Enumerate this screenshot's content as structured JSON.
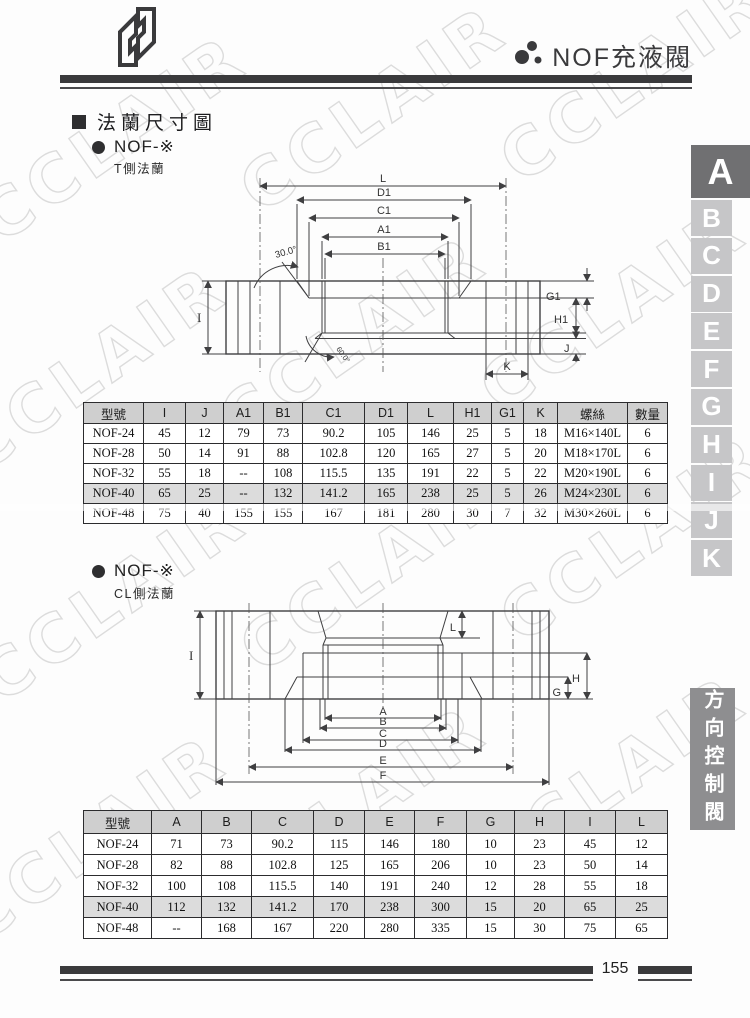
{
  "header": {
    "title": "NOF充液閥"
  },
  "section": {
    "title": "法蘭尺寸圖"
  },
  "groups": [
    {
      "label": "NOF-※",
      "sublabel": "T側法蘭"
    },
    {
      "label": "NOF-※",
      "sublabel": "CL側法蘭"
    }
  ],
  "drawing1": {
    "top_dims": [
      "L",
      "D1",
      "C1",
      "A1",
      "B1"
    ],
    "left_dim": "I",
    "right_dims": [
      "G1",
      "H1",
      "J"
    ],
    "bottom_dim": "K",
    "angle_top": "30.0°",
    "angle_bottom": "60.0°"
  },
  "drawing2": {
    "top_dim": "L",
    "left_dim": "I",
    "right_dims": [
      "H",
      "G"
    ],
    "bottom_dims": [
      "A",
      "B",
      "C",
      "D",
      "E",
      "F"
    ]
  },
  "table1": {
    "headers": [
      "型號",
      "I",
      "J",
      "A1",
      "B1",
      "C1",
      "D1",
      "L",
      "H1",
      "G1",
      "K",
      "螺絲",
      "數量"
    ],
    "rows": [
      [
        "NOF-24",
        "45",
        "12",
        "79",
        "73",
        "90.2",
        "105",
        "146",
        "25",
        "5",
        "18",
        "M16×140L",
        "6"
      ],
      [
        "NOF-28",
        "50",
        "14",
        "91",
        "88",
        "102.8",
        "120",
        "165",
        "27",
        "5",
        "20",
        "M18×170L",
        "6"
      ],
      [
        "NOF-32",
        "55",
        "18",
        "--",
        "108",
        "115.5",
        "135",
        "191",
        "22",
        "5",
        "22",
        "M20×190L",
        "6"
      ],
      [
        "NOF-40",
        "65",
        "25",
        "--",
        "132",
        "141.2",
        "165",
        "238",
        "25",
        "5",
        "26",
        "M24×230L",
        "6"
      ],
      [
        "NOF-48",
        "75",
        "40",
        "155",
        "155",
        "167",
        "181",
        "280",
        "30",
        "7",
        "32",
        "M30×260L",
        "6"
      ]
    ],
    "highlight_row_index": 3
  },
  "table2": {
    "headers": [
      "型號",
      "A",
      "B",
      "C",
      "D",
      "E",
      "F",
      "G",
      "H",
      "I",
      "L"
    ],
    "rows": [
      [
        "NOF-24",
        "71",
        "73",
        "90.2",
        "115",
        "146",
        "180",
        "10",
        "23",
        "45",
        "12"
      ],
      [
        "NOF-28",
        "82",
        "88",
        "102.8",
        "125",
        "165",
        "206",
        "10",
        "23",
        "50",
        "14"
      ],
      [
        "NOF-32",
        "100",
        "108",
        "115.5",
        "140",
        "191",
        "240",
        "12",
        "28",
        "55",
        "18"
      ],
      [
        "NOF-40",
        "112",
        "132",
        "141.2",
        "170",
        "238",
        "300",
        "15",
        "20",
        "65",
        "25"
      ],
      [
        "NOF-48",
        "--",
        "168",
        "167",
        "220",
        "280",
        "335",
        "15",
        "30",
        "75",
        "65"
      ]
    ],
    "highlight_row_index": 3
  },
  "sidebar": {
    "tabs": [
      "A",
      "B",
      "C",
      "D",
      "E",
      "F",
      "G",
      "H",
      "I",
      "J",
      "K"
    ],
    "active_tab": "A",
    "category_label": "方向控制閥"
  },
  "footer": {
    "page_number": "155"
  },
  "watermark": {
    "text": "CCLAIR"
  },
  "colors": {
    "bar": "#3a3a3c",
    "table_header_bg": "#cfcfcf",
    "highlight_row_bg": "#dcdcdc",
    "tab_active_bg": "#707072",
    "tab_bg": "#c6c6c8",
    "category_bg": "#8e8e90"
  }
}
